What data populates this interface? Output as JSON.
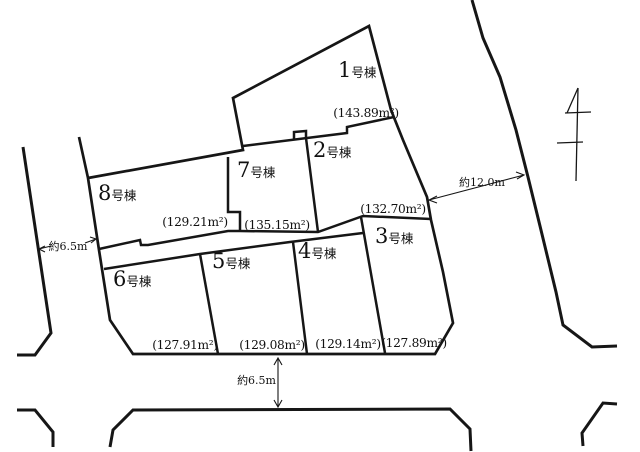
{
  "diagram": {
    "type": "residential-lot-layout-plan",
    "lots": [
      {
        "number": "1",
        "suffix": "号棟",
        "area_label": "(143.89m²)",
        "area_sqm": 143.89
      },
      {
        "number": "2",
        "suffix": "号棟",
        "area_label": "(132.70m²)",
        "area_sqm": 132.7
      },
      {
        "number": "3",
        "suffix": "号棟",
        "area_label": "(127.89m²)",
        "area_sqm": 127.89
      },
      {
        "number": "4",
        "suffix": "号棟",
        "area_label": "(129.14m²)",
        "area_sqm": 129.14
      },
      {
        "number": "5",
        "suffix": "号棟",
        "area_label": "(129.08m²)",
        "area_sqm": 129.08
      },
      {
        "number": "6",
        "suffix": "号棟",
        "area_label": "(127.91m²)",
        "area_sqm": 127.91
      },
      {
        "number": "7",
        "suffix": "号棟",
        "area_label": "(135.15m²)",
        "area_sqm": 135.15
      },
      {
        "number": "8",
        "suffix": "号棟",
        "area_label": "(129.21m²)",
        "area_sqm": 129.21
      }
    ],
    "dimensions": {
      "right_road_width": "約12.0m",
      "left_road_width": "約6.5m",
      "bottom_road_width": "約6.5m"
    }
  },
  "colors": {
    "line": "#161616",
    "background": "#ffffff"
  }
}
